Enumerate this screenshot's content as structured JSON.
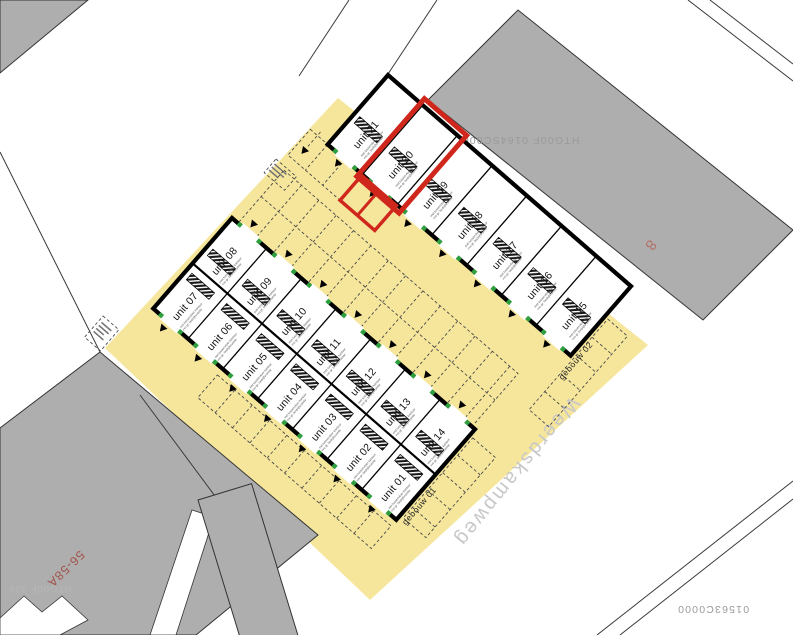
{
  "street": {
    "name": "Weerdskampweg"
  },
  "buildings": [
    {
      "id": "gebouw-01",
      "label": "gebouw 01"
    },
    {
      "id": "gebouw-02",
      "label": "gebouw 02"
    }
  ],
  "units": [
    {
      "number": "01",
      "label": "unit 01"
    },
    {
      "number": "02",
      "label": "unit 02"
    },
    {
      "number": "03",
      "label": "unit 03"
    },
    {
      "number": "04",
      "label": "unit 04"
    },
    {
      "number": "05",
      "label": "unit 05"
    },
    {
      "number": "06",
      "label": "unit 06"
    },
    {
      "number": "07",
      "label": "unit 07"
    },
    {
      "number": "08",
      "label": "unit 08"
    },
    {
      "number": "09",
      "label": "unit 09"
    },
    {
      "number": "10",
      "label": "unit 10"
    },
    {
      "number": "11",
      "label": "unit 11"
    },
    {
      "number": "12",
      "label": "unit 12"
    },
    {
      "number": "13",
      "label": "unit 13"
    },
    {
      "number": "14",
      "label": "unit 14"
    },
    {
      "number": "15",
      "label": "unit 15"
    },
    {
      "number": "16",
      "label": "unit 16"
    },
    {
      "number": "17",
      "label": "unit 17"
    },
    {
      "number": "18",
      "label": "unit 18"
    },
    {
      "number": "19",
      "label": "unit 19"
    },
    {
      "number": "20",
      "label": "unit 20"
    },
    {
      "number": "21",
      "label": "unit 21"
    }
  ],
  "unit_sub_lines": [
    "met tussenvloer kantoor",
    "vvo gr. bedrijfsruimte"
  ],
  "highlight": {
    "unit": "unit 20"
  },
  "parcel_labels": {
    "top_right": "HTG00F 0164SC0000",
    "bottom_right": "01563C0000",
    "bottom_left": "HTG00F 025",
    "neighbor_address": "56-58A",
    "neighbor_number": "8"
  },
  "colors": {
    "site": "#f6e69b",
    "neighbors": "#aeaeae",
    "highlight": "#d0271d",
    "doors": "#2e9e3e"
  }
}
